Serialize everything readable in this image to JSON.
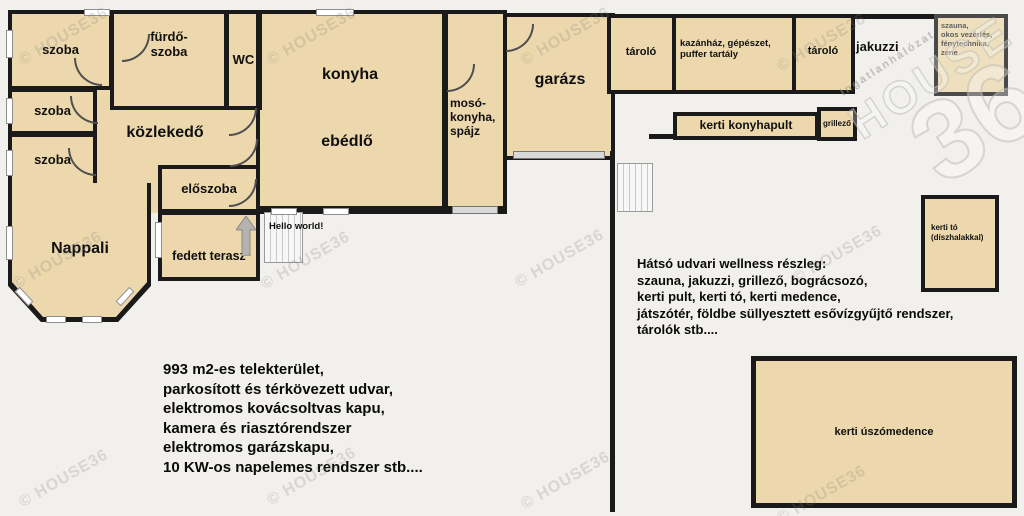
{
  "colors": {
    "wall": "#1a1a1a",
    "room_fill": "#ecd8ac",
    "background": "#f1f0ec",
    "watermark": "#7d7c76"
  },
  "watermark": {
    "text": "© HOUSE36"
  },
  "logo": {
    "tagline": "Ingatlanhálózat",
    "brand": "HOUSE",
    "number": "36"
  },
  "rooms": {
    "szoba_top": "szoba",
    "szoba_mid": "szoba",
    "szoba_low": "szoba",
    "furdoszoba": "fürdő-\nszoba",
    "wc": "WC",
    "kozlekedo": "közlekedő",
    "konyha": "konyha",
    "ebedlo": "ebédlő",
    "moso": "mosó-\nkonyha,\nspájz",
    "eloszoba": "előszoba",
    "terasz": "fedett terasz",
    "nappali": "Nappali",
    "garazs": "garázs",
    "tarolo1": "tároló",
    "kazanhaz": "kazánház, gépészet,\npuffer tartály",
    "tarolo2": "tároló",
    "jakuzzi": "jakuzzi",
    "szauna_box": "szauna,\nokos vezérlés,\nfénytechnika,\nzene",
    "kerti_konyhapult": "kerti konyhapult",
    "grillezo": "grillező",
    "kerti_to": "kerti tó\n(díszhalakkal)",
    "uszomedence": "kerti úszómedence"
  },
  "annotations": {
    "hello": "Hello world!",
    "wellness": "Hátsó udvari wellness részleg:\nszauna, jakuzzi, grillező, bográcsozó,\nkerti pult, kerti tó, kerti medence,\njátszótér, földbe süllyesztett esővízgyűjtő rendszer,\ntárolók stb....",
    "features": "993 m2-es telekterület,\nparkosított és térkövezett udvar,\nelektromos kovácsoltvas kapu,\nkamera és riasztórendszer\nelektromos garázskapu,\n10 KW-os napelemes rendszer stb...."
  }
}
